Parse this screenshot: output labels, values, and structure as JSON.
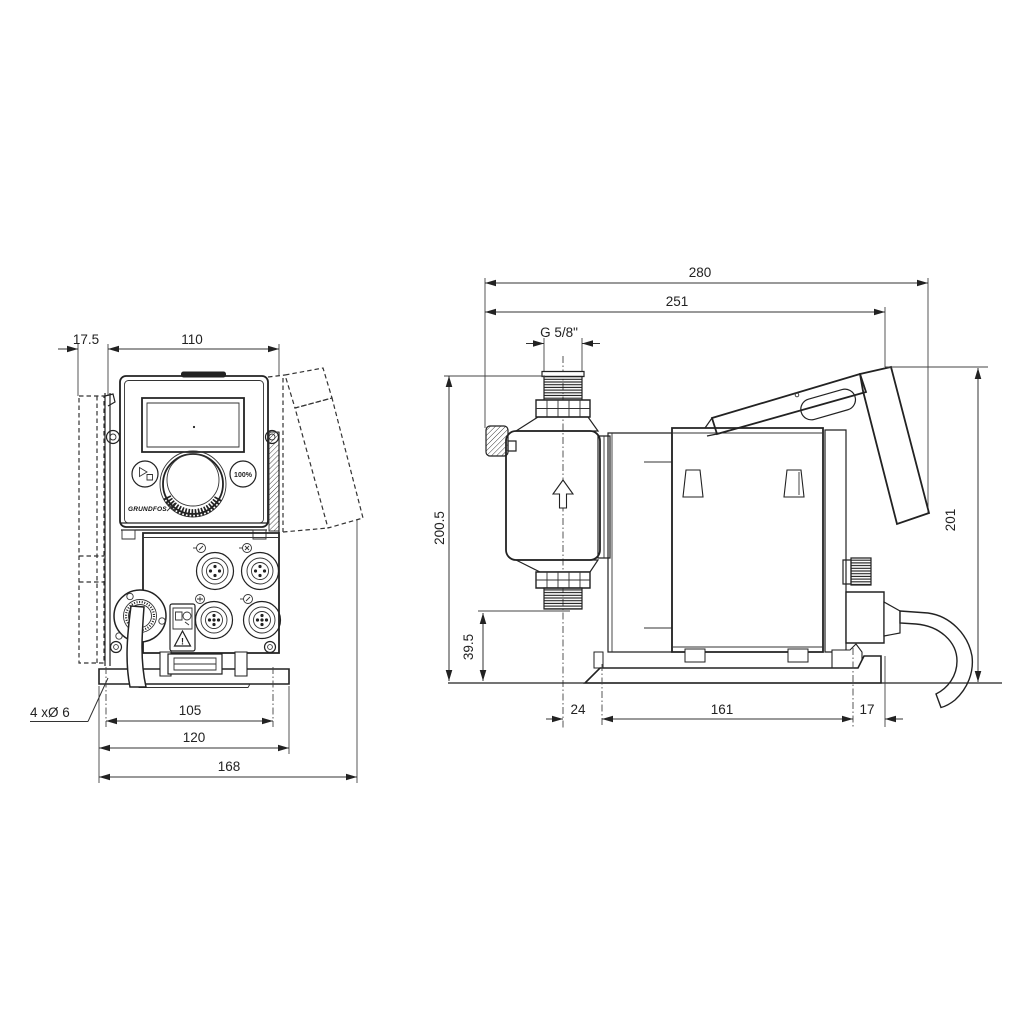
{
  "drawing": {
    "colors": {
      "background": "#ffffff",
      "line": "#222222"
    },
    "front_view": {
      "dimensions": {
        "bracket_depth": "17.5",
        "panel_width": "110",
        "hole_spacing": "105",
        "plate_width": "120",
        "overall_width": "168"
      },
      "mounting_holes_label": "4 xØ 6",
      "control_panel": {
        "button_100_label": "100%",
        "logo_text": "GRUNDFOS",
        "warning_mark": "!"
      },
      "icons": {
        "start_stop_button": "play-stop-icon",
        "dial": "click-wheel-knob",
        "connectors": "m12-socket",
        "warning": "warning-triangle-icon",
        "cable_gland": "cable-gland-flange"
      }
    },
    "side_view": {
      "dimensions": {
        "overall_depth": "280",
        "depth_to_hood": "251",
        "thread_label": "G 5/8\"",
        "overall_height": "200.5",
        "suction_valve_height": "39.5",
        "hood_height": "201",
        "front_offset": "24",
        "base_plate_length": "161",
        "rear_offset": "17"
      },
      "icons": {
        "flow_arrow": "arrow-up-icon",
        "air_bleed": "bleed-valve-knob",
        "power_cable": "power-cable"
      }
    }
  }
}
